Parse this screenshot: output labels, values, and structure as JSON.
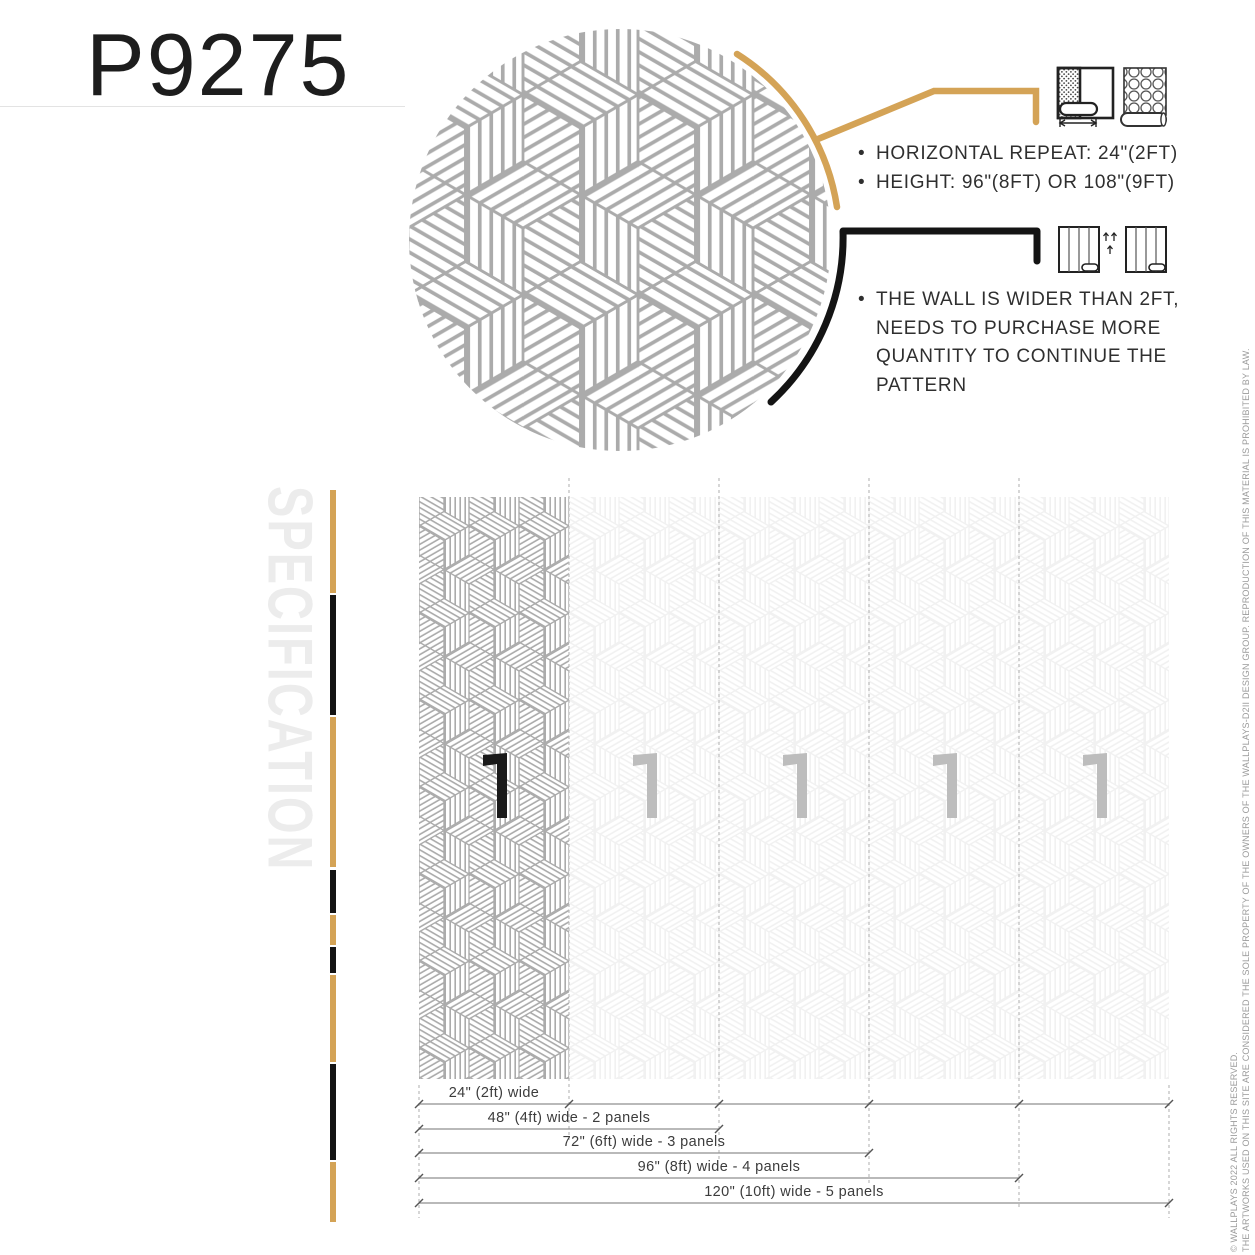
{
  "product": {
    "code": "P9275"
  },
  "colors": {
    "gold": "#d4a356",
    "black": "#141414",
    "pattern_line": "#ababab",
    "mark_dark": "#1a1a1a",
    "mark_light": "#bdbdbd",
    "dim_line": "#8f8f8f",
    "tick": "#555555",
    "dash": "#bcbcbc"
  },
  "callouts": {
    "repeat": {
      "icon": "wallpaper-width-and-roll-icons",
      "items": [
        "HORIZONTAL REPEAT: 24\"(2FT)",
        "HEIGHT: 96\"(8FT) OR 108\"(9FT)"
      ]
    },
    "coverage": {
      "icon": "panel-continuation-icons",
      "lines": [
        "THE WALL IS WIDER THAN 2FT,",
        "NEEDS TO PURCHASE MORE",
        "QUANTITY TO CONTINUE THE",
        "PATTERN"
      ]
    }
  },
  "section": {
    "label": "SPECIFICATION"
  },
  "diagram": {
    "panel_count": 5,
    "panel_mark_glyph": "1",
    "dimension_rows": [
      {
        "label": "24\" (2ft) wide",
        "panels": 1,
        "full_line": true
      },
      {
        "label": "48\" (4ft) wide - 2 panels",
        "panels": 2,
        "full_line": false
      },
      {
        "label": "72\" (6ft) wide - 3 panels",
        "panels": 3,
        "full_line": false
      },
      {
        "label": "96\" (8ft) wide - 4 panels",
        "panels": 4,
        "full_line": false
      },
      {
        "label": "120\" (10ft) wide - 5 panels",
        "panels": 5,
        "full_line": false
      }
    ]
  },
  "sidebar": {
    "segments": [
      {
        "color": "gold",
        "top": 490,
        "h": 103
      },
      {
        "color": "black",
        "top": 595,
        "h": 120
      },
      {
        "color": "gold",
        "top": 717,
        "h": 150
      },
      {
        "color": "black",
        "top": 870,
        "h": 43
      },
      {
        "color": "gold",
        "top": 915,
        "h": 30
      },
      {
        "color": "black",
        "top": 947,
        "h": 26
      },
      {
        "color": "gold",
        "top": 975,
        "h": 87
      },
      {
        "color": "black",
        "top": 1064,
        "h": 96
      },
      {
        "color": "gold",
        "top": 1162,
        "h": 60
      }
    ]
  },
  "footer": {
    "line1": "© WALLPLAYS 2022 ALL RIGHTS RESERVED.",
    "line2": "THE ARTWORKS USED ON THIS SITE ARE CONSIDERED THE SOLE PROPERTY OF THE OWNERS OF THE WALLPLAYS-D2II DESIGN GROUP. REPRODUCTION OF THIS MATERIAL IS PROHIBITED BY LAW."
  }
}
